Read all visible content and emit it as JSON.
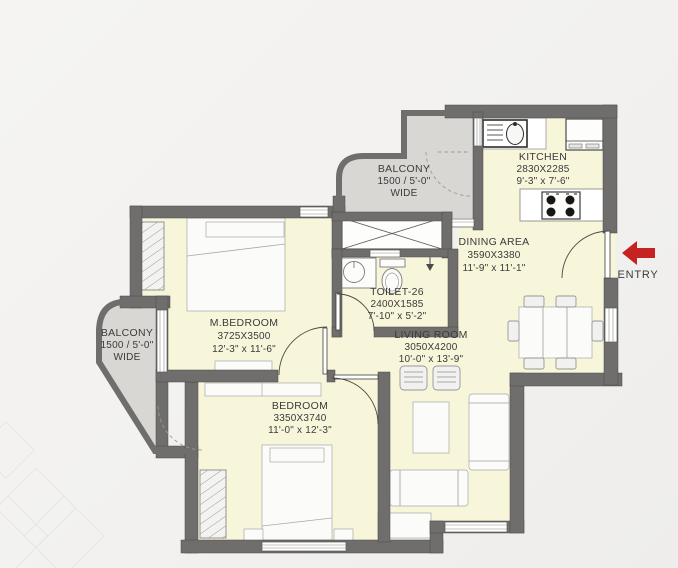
{
  "plan_type": "apartment-floor-plan",
  "rooms": {
    "balcony_top": {
      "name": "BALCONY",
      "size": "1500 / 5'-0\"",
      "note": "WIDE"
    },
    "kitchen": {
      "name": "KITCHEN",
      "size_mm": "2830X2285",
      "size_ft": "9'-3\" x 7'-6\""
    },
    "dining": {
      "name": "DINING AREA",
      "size_mm": "3590X3380",
      "size_ft": "11'-9\" x 11'-1\""
    },
    "toilet": {
      "name": "TOILET-26",
      "size_mm": "2400X1585",
      "size_ft": "7'-10\" x 5'-2\""
    },
    "living": {
      "name": "LIVING ROOM",
      "size_mm": "3050X4200",
      "size_ft": "10'-0\" x 13'-9\""
    },
    "master_bedroom": {
      "name": "M.BEDROOM",
      "size_mm": "3725X3500",
      "size_ft": "12'-3\" x 11'-6\""
    },
    "balcony_left": {
      "name": "BALCONY",
      "size": "1500 / 5'-0\"",
      "note": "WIDE"
    },
    "bedroom": {
      "name": "BEDROOM",
      "size_mm": "3350X3740",
      "size_ft": "11'-0\" x 12'-3\""
    }
  },
  "entry": {
    "label": "ENTRY"
  },
  "colors": {
    "wall": "#6f6e6c",
    "room_floor": "#f7f5da",
    "balcony_floor": "#d8d7d4",
    "entry_arrow": "#c62222",
    "text": "#3b3b3b",
    "background": "#f2f1ef"
  }
}
